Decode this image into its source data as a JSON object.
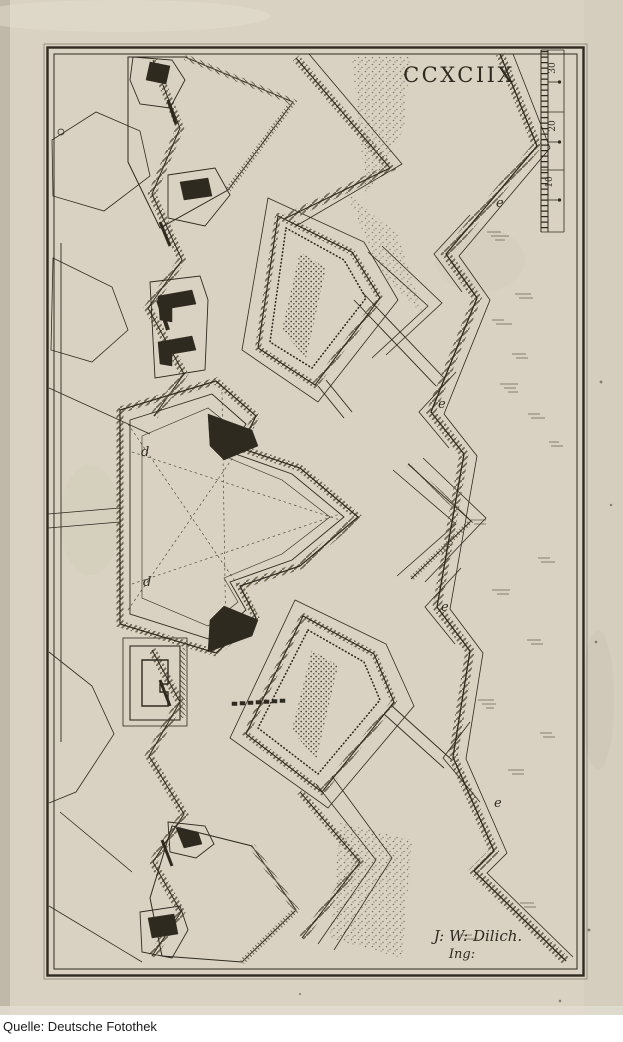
{
  "window": {
    "caption": "Quelle: Deutsche Fotothek"
  },
  "plate": {
    "title": "CCXCIIX",
    "signature": {
      "line1": "J: W: Dilich.",
      "line2": "Ing:"
    },
    "scale_bar": {
      "labels": [
        "30",
        "20",
        "10"
      ]
    },
    "map_letters": {
      "d_upper": "d",
      "d_lower": "d",
      "e_top": "e",
      "e_upper": "e",
      "e_lower": "e",
      "e_bottom": "e"
    }
  },
  "colors": {
    "paper": "#d9d2c2",
    "paper_margin": "#d3ccbc",
    "ink": "#2f2a20",
    "hatch": "#6e6553",
    "caption_bg": "#ffffff",
    "caption_text": "#1b1b1b"
  }
}
